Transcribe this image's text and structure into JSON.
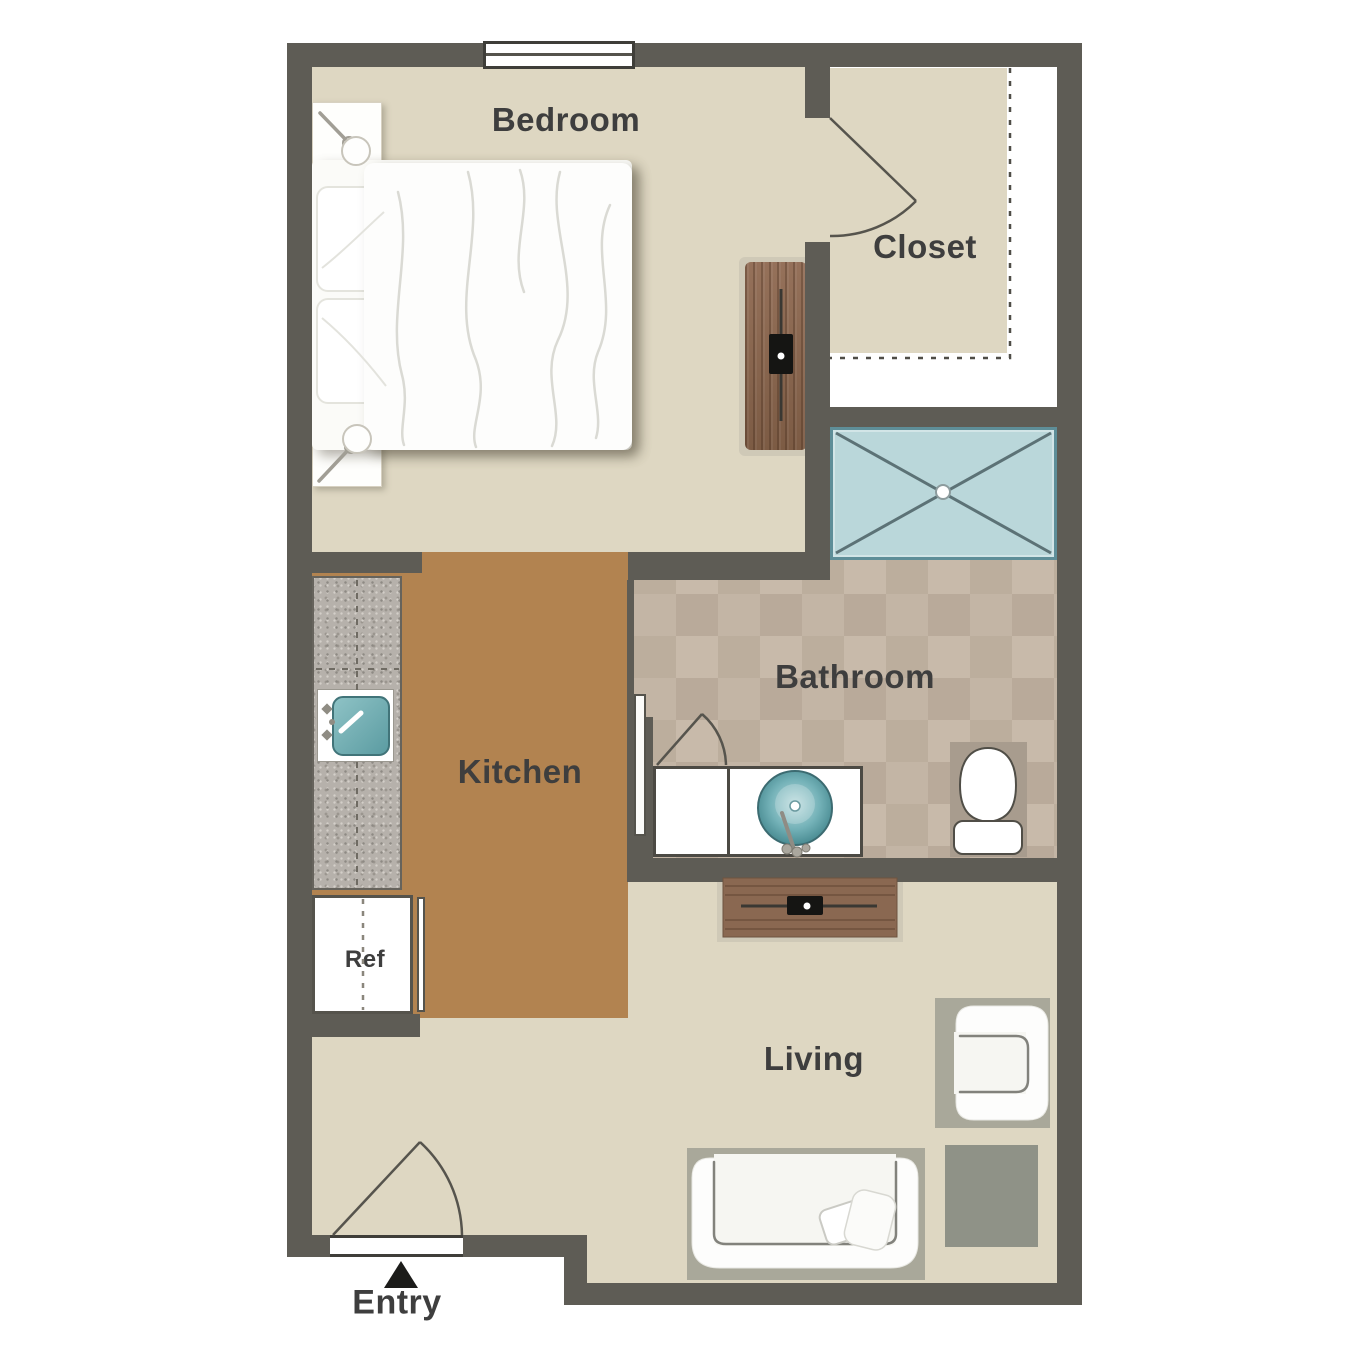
{
  "title": "Studio apartment floor plan",
  "rooms": {
    "bedroom": {
      "label": "Bedroom"
    },
    "closet": {
      "label": "Closet"
    },
    "bathroom": {
      "label": "Bathroom"
    },
    "kitchen": {
      "label": "Kitchen"
    },
    "living": {
      "label": "Living"
    }
  },
  "annotations": {
    "entry": {
      "label": "Entry"
    },
    "refrigerator": {
      "label": "Ref"
    }
  },
  "fixtures": [
    "window",
    "bed",
    "pillows",
    "duvet",
    "nightstand-top",
    "nightstand-bottom",
    "table-lamp-top",
    "table-lamp-bottom",
    "dresser",
    "bedroom-tv",
    "closet-door",
    "closet-shelf-dashed-outline",
    "shower",
    "shower-drain",
    "pocket-door",
    "bathroom-door-swing",
    "vanity",
    "vessel-sink",
    "vanity-faucet",
    "toilet",
    "kitchen-counter",
    "kitchen-sink",
    "kitchen-faucet",
    "counter-dashed-line",
    "refrigerator",
    "media-console",
    "living-tv",
    "armchair",
    "armchair-rug",
    "sofa",
    "sofa-rug",
    "throw-pillow",
    "throw-blanket",
    "side-table",
    "entry-door",
    "entry-arrow"
  ],
  "colors": {
    "wall": "#5e5c55",
    "floor_tan": "#ded7c2",
    "kitchen_floor": "#b28350",
    "bath_tile": "#c1b2a2",
    "shower_blue": "#bad7da",
    "sink_teal": "#4f9ca4",
    "rug_gray": "#a9a89a",
    "side_table_gray": "#8f9287",
    "wood_brown": "#8a6851",
    "label_text": "#3e3e3e",
    "background": "#ffffff"
  }
}
